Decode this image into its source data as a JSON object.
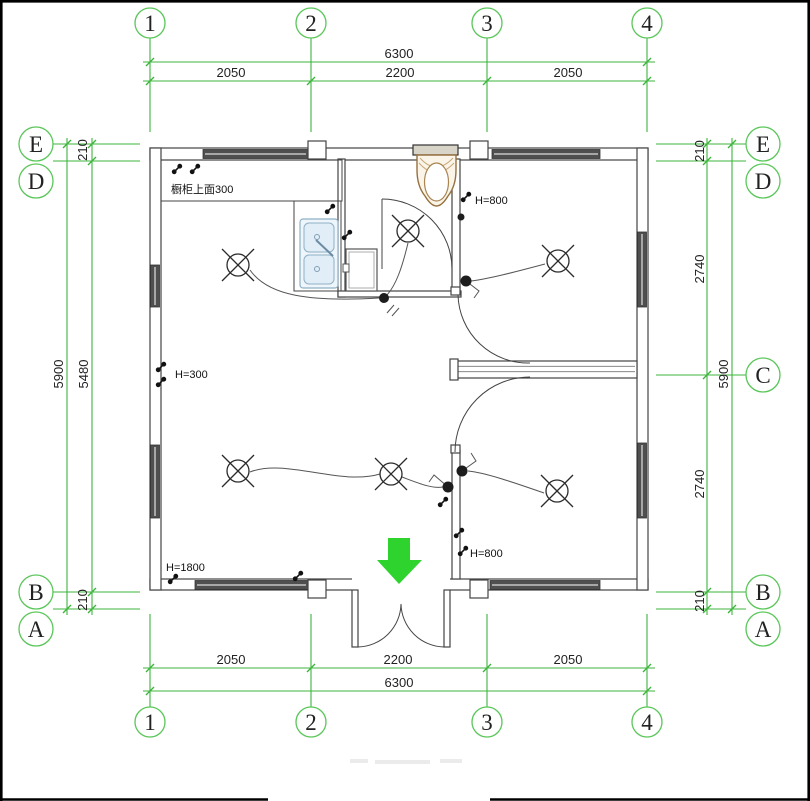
{
  "drawing_type": "electrical floor plan",
  "colors": {
    "grid_green": "#3cb43c",
    "arrow_green": "#2ed32e",
    "wall": "#444444",
    "window_fill": "#4f4f4f",
    "text": "#1f1f1f",
    "toilet_outline": "#96713f",
    "sink_outline": "#8fb0c5"
  },
  "grid": {
    "columns": [
      {
        "label": "1"
      },
      {
        "label": "2"
      },
      {
        "label": "3"
      },
      {
        "label": "4"
      }
    ],
    "rows_left": [
      {
        "label": "E"
      },
      {
        "label": "D"
      },
      {
        "label": "B"
      },
      {
        "label": "A"
      }
    ],
    "rows_right": [
      {
        "label": "E"
      },
      {
        "label": "D"
      },
      {
        "label": "C"
      },
      {
        "label": "B"
      },
      {
        "label": "A"
      }
    ]
  },
  "dimensions": {
    "top": {
      "overall": "6300",
      "segments": [
        "2050",
        "2200",
        "2050"
      ]
    },
    "bottom": {
      "overall": "6300",
      "segments": [
        "2050",
        "2200",
        "2050"
      ]
    },
    "left": {
      "overall": "5900",
      "inner": "5480",
      "gap_top": "210",
      "gap_bottom": "210"
    },
    "right": {
      "overall": "5900",
      "gap_top": "210",
      "upper": "2740",
      "lower": "2740",
      "gap_bottom": "210"
    }
  },
  "annotations": {
    "cabinet_note": "橱柜上面300",
    "switch_height_left": "H=300",
    "switch_height_bath": "H=800",
    "switch_height_hall": "H=800",
    "switch_height_entry": "H=1800"
  },
  "symbols": {
    "ceiling_lamp": "ceiling lamp (circle with cross)",
    "wall_switch": "wall switch",
    "junction_box": "junction box dot",
    "entrance_arrow": "entrance direction arrow"
  }
}
